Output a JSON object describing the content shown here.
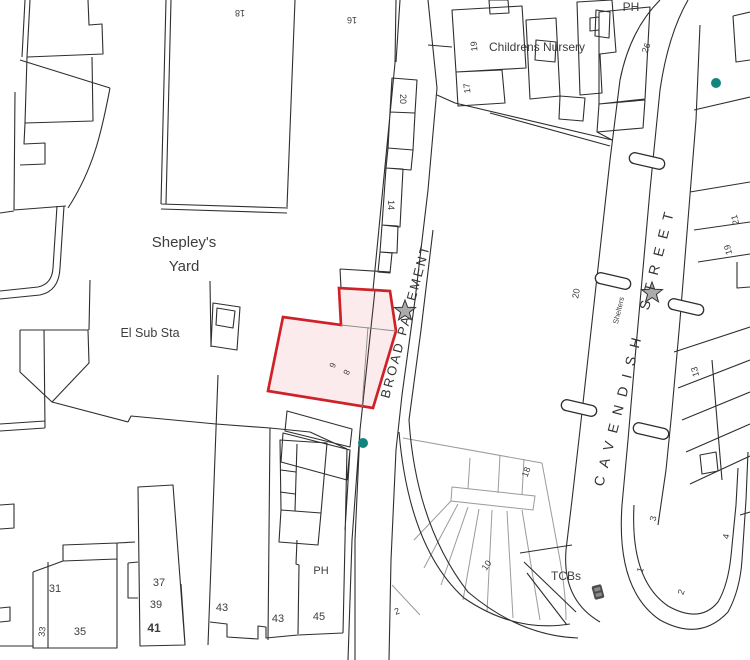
{
  "map": {
    "background": "#ffffff",
    "line_color": "#2e2e2e",
    "grey_line_color": "#9b9b9b",
    "highlight": {
      "stroke": "#cf2128",
      "fill": "rgba(208,32,42,0.09)"
    },
    "teal_dot_color": "#12847e",
    "star_fill": "#ababab",
    "street_labels": {
      "broad_pavement": {
        "part1": "BROAD PA",
        "part2": "EMENT"
      },
      "cavendish": {
        "part1": "CAVENDISH",
        "part2": "STREET"
      }
    },
    "region_labels": [
      {
        "id": "no-18-top",
        "text": "18",
        "x": 240,
        "y": 10,
        "r": 180,
        "s": 9
      },
      {
        "id": "no-16-top",
        "text": "16",
        "x": 352,
        "y": 17,
        "r": 180,
        "s": 9
      },
      {
        "id": "ph-top",
        "text": "PH",
        "x": 631,
        "y": 11,
        "r": 0,
        "s": 12
      },
      {
        "id": "childrens-nursery",
        "text": "Childrens Nursery",
        "x": 537,
        "y": 51,
        "r": 0,
        "s": 12
      },
      {
        "id": "no-19-nursery",
        "text": "19",
        "x": 477,
        "y": 46,
        "r": -96,
        "s": 9
      },
      {
        "id": "no-17-nursery",
        "text": "17",
        "x": 470,
        "y": 88,
        "r": -96,
        "s": 9
      },
      {
        "id": "no-26",
        "text": "26",
        "x": 649,
        "y": 49,
        "r": -70,
        "s": 9
      },
      {
        "id": "no-20-strip",
        "text": "20",
        "x": 400,
        "y": 99,
        "r": 90,
        "s": 9
      },
      {
        "id": "no-14-strip",
        "text": "14",
        "x": 388,
        "y": 205,
        "r": 90,
        "s": 9
      },
      {
        "id": "shepleys-yard-1",
        "text": "Shepley's",
        "x": 184,
        "y": 247,
        "r": 0,
        "s": 15
      },
      {
        "id": "shepleys-yard-2",
        "text": "Yard",
        "x": 184,
        "y": 271,
        "r": 0,
        "s": 15
      },
      {
        "id": "el-sub-sta",
        "text": "El Sub Sta",
        "x": 150,
        "y": 337,
        "r": 0,
        "s": 12.5
      },
      {
        "id": "plot-no-6",
        "text": "6",
        "x": 330,
        "y": 364,
        "r": 115,
        "s": 8.5,
        "c": "#6a6a6a"
      },
      {
        "id": "plot-no-8",
        "text": "8",
        "x": 344,
        "y": 371,
        "r": 115,
        "s": 8.5,
        "c": "#6a6a6a"
      },
      {
        "id": "no-20-block",
        "text": "20",
        "x": 579,
        "y": 294,
        "r": -80,
        "s": 9
      },
      {
        "id": "shelters",
        "text": "Shelters",
        "x": 621,
        "y": 311,
        "r": -77,
        "s": 7.5,
        "c": "#666666"
      },
      {
        "id": "no-21-east",
        "text": "21",
        "x": 738,
        "y": 219,
        "r": -105,
        "s": 9
      },
      {
        "id": "no-19-east",
        "text": "19",
        "x": 731,
        "y": 249,
        "r": -105,
        "s": 9
      },
      {
        "id": "no-13-east",
        "text": "13",
        "x": 698,
        "y": 371,
        "r": -105,
        "s": 9
      },
      {
        "id": "no-3-east",
        "text": "3",
        "x": 656,
        "y": 519,
        "r": -78,
        "s": 9
      },
      {
        "id": "no-4-east",
        "text": "4",
        "x": 729,
        "y": 537,
        "r": -78,
        "s": 9
      },
      {
        "id": "no-1-block",
        "text": "1",
        "x": 643,
        "y": 571,
        "r": -70,
        "s": 9
      },
      {
        "id": "no-2-block",
        "text": "2",
        "x": 684,
        "y": 593,
        "r": -70,
        "s": 9
      },
      {
        "id": "tcbs",
        "text": "TCBs",
        "x": 566,
        "y": 580,
        "r": 0,
        "s": 12
      },
      {
        "id": "no-18-grey",
        "text": "18",
        "x": 529,
        "y": 473,
        "r": -70,
        "s": 9,
        "c": "#8a8a8a"
      },
      {
        "id": "no-10-grey",
        "text": "10",
        "x": 489,
        "y": 567,
        "r": -55,
        "s": 9,
        "c": "#8a8a8a"
      },
      {
        "id": "no-2-grey",
        "text": "2",
        "x": 398,
        "y": 614,
        "r": -20,
        "s": 9,
        "c": "#8a8a8a"
      },
      {
        "id": "no-31",
        "text": "31",
        "x": 55,
        "y": 592,
        "r": 0,
        "s": 11
      },
      {
        "id": "no-33",
        "text": "33",
        "x": 45,
        "y": 632,
        "r": -83,
        "s": 9
      },
      {
        "id": "no-35",
        "text": "35",
        "x": 80,
        "y": 635,
        "r": 0,
        "s": 11
      },
      {
        "id": "no-37",
        "text": "37",
        "x": 159,
        "y": 586,
        "r": 0,
        "s": 11
      },
      {
        "id": "no-39",
        "text": "39",
        "x": 156,
        "y": 608,
        "r": 0,
        "s": 11
      },
      {
        "id": "no-41",
        "text": "41",
        "x": 154,
        "y": 632,
        "r": 0,
        "s": 12,
        "w": "bold"
      },
      {
        "id": "no-43-a",
        "text": "43",
        "x": 222,
        "y": 611,
        "r": 0,
        "s": 11
      },
      {
        "id": "no-43-b",
        "text": "43",
        "x": 278,
        "y": 622,
        "r": 0,
        "s": 11
      },
      {
        "id": "no-45",
        "text": "45",
        "x": 319,
        "y": 620,
        "r": 0,
        "s": 11
      },
      {
        "id": "ph-south",
        "text": "PH",
        "x": 321,
        "y": 574,
        "r": 0,
        "s": 11
      }
    ],
    "symbols": {
      "stars": [
        {
          "x": 405,
          "y": 311
        },
        {
          "x": 652,
          "y": 293
        }
      ],
      "teal_dots": [
        {
          "x": 716,
          "y": 83
        },
        {
          "x": 363,
          "y": 443
        }
      ],
      "shelters": [
        {
          "x": 647,
          "y": 161,
          "angle": -77
        },
        {
          "x": 613,
          "y": 281,
          "angle": -77
        },
        {
          "x": 686,
          "y": 307,
          "angle": -77
        },
        {
          "x": 579,
          "y": 408,
          "angle": -77
        },
        {
          "x": 651,
          "y": 431,
          "angle": -77
        }
      ],
      "tcb_box": {
        "x": 598,
        "y": 592
      }
    }
  }
}
